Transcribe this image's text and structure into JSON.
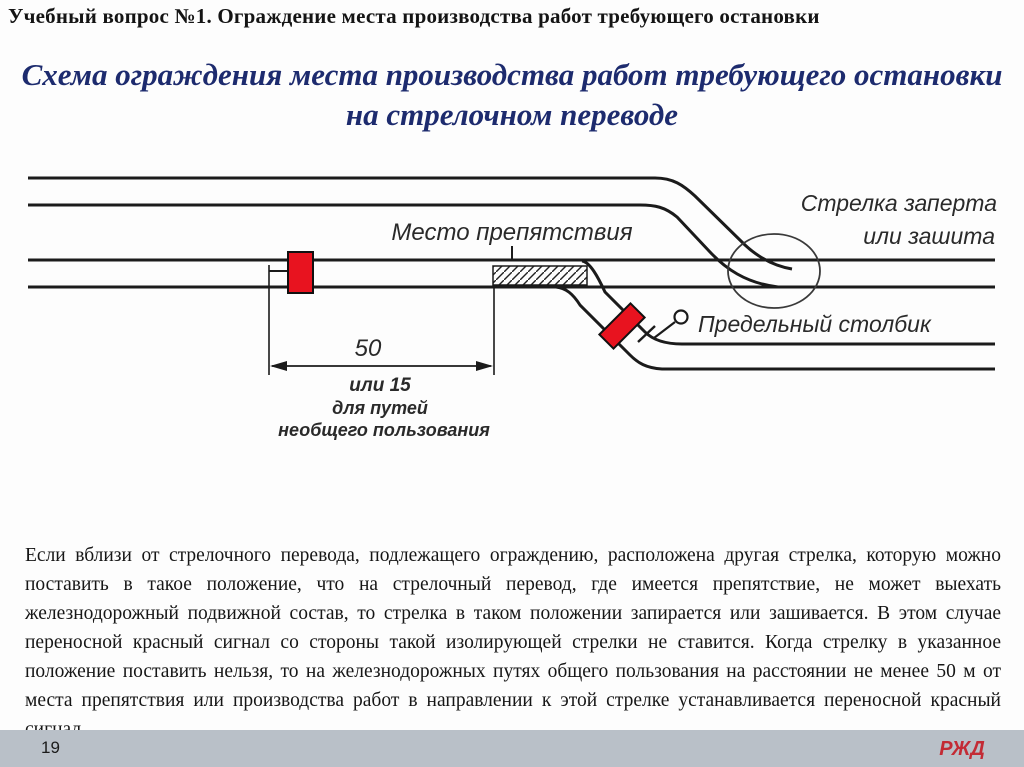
{
  "slide": {
    "header": "Учебный вопрос №1. Ограждение места производства работ требующего остановки",
    "title": {
      "line1": "Схема ограждения места производства работ требующего остановки",
      "line2": "на стрелочном переводе"
    },
    "body_paragraph": "Если вблизи от стрелочного перевода, подлежащего ограждению, расположена другая стрелка, которую можно поставить в такое положение, что на стрелочный перевод, где имеется препятствие, не может выехать железнодорожный подвижной состав, то стрелка в таком положении запирается или зашивается. В этом случае переносной красный сигнал со стороны такой изолирующей стрелки не ставится. Когда стрелку в указанное положение поставить нельзя, то на железнодорожных путях общего пользования на расстоянии не менее 50 м от места препятствия или производства работ в направлении к этой стрелке устанавливается переносной красный сигнал",
    "footer": {
      "page_number": "19",
      "logo_text": "РЖД"
    }
  },
  "diagram": {
    "labels": {
      "obstacle": "Место препятствия",
      "switch_locked_line1": "Стрелка заперта",
      "switch_locked_line2": "или зашита",
      "limit_post": "Предельный столбик"
    },
    "dimension": {
      "value": "50",
      "alt_line1": "или 15",
      "alt_line2": "для путей",
      "alt_line3": "необщего пользования"
    },
    "colors": {
      "signal_red": "#e8131f",
      "track_black": "#1b1b1b",
      "title_navy": "#1d2b6e",
      "footer_bar": "#b9c0c8",
      "logo_red": "#c32b35"
    }
  }
}
